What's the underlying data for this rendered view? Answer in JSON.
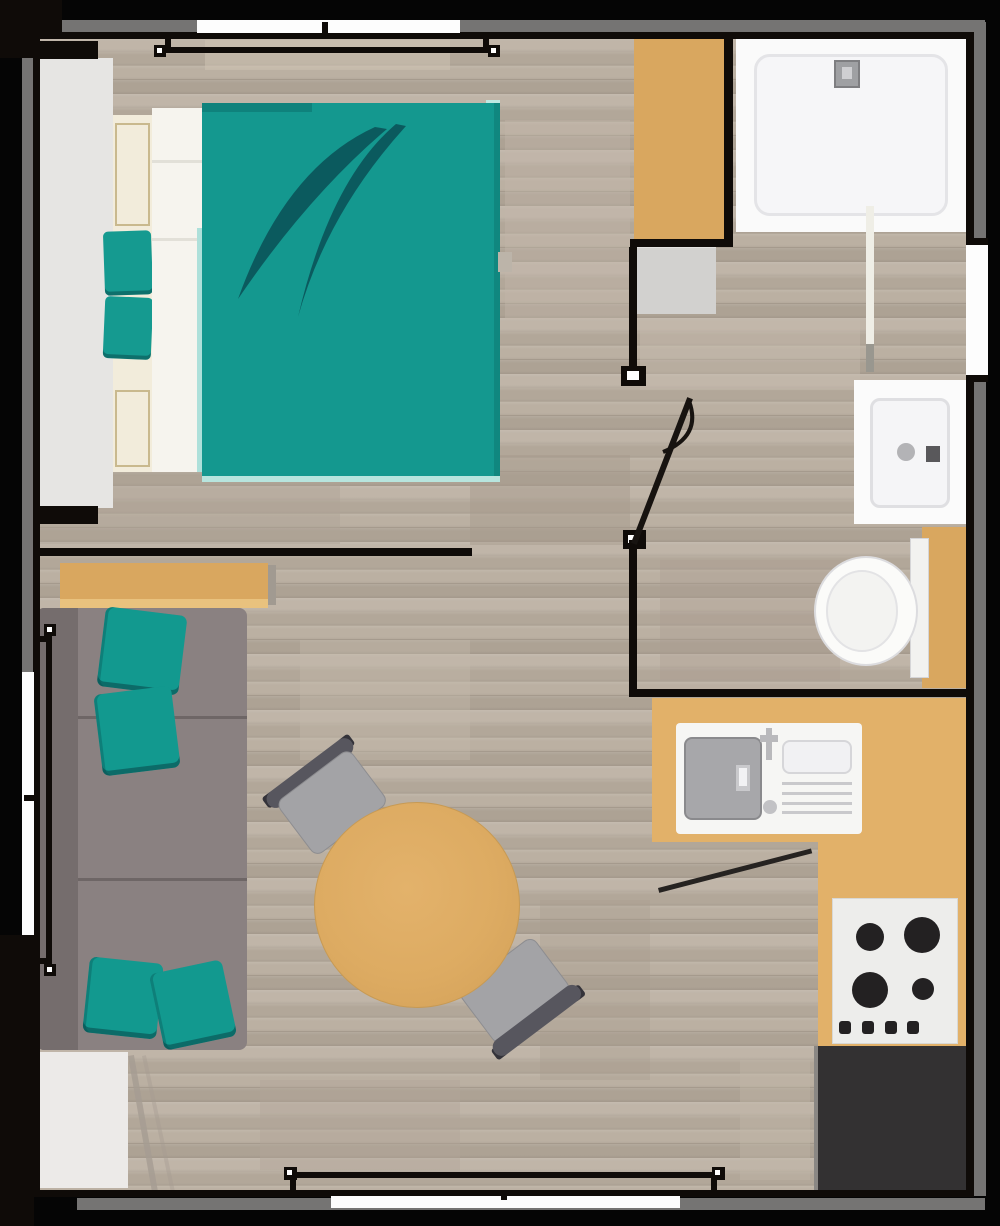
{
  "title": "Studio apartment floor plan (top-down render)",
  "palette": {
    "wall": "#0f0b08",
    "wall_band": "#757473",
    "floor_wood": "#b6ab9e",
    "accent_teal": "#14988f",
    "accent_teal_dark": "#0b5a5e",
    "furniture_tan": "#d9a75f",
    "counter_tan": "#e2b169",
    "sofa_gray": "#8a8181",
    "fixture_white": "#fafafa",
    "appliance_charcoal": "#333132"
  },
  "rooms": {
    "bedroom": {
      "label": "Bedroom",
      "items": [
        "double bed with teal duvet",
        "two teal pillows",
        "light-gray wardrobe",
        "tall tan cabinet",
        "gray dresser"
      ]
    },
    "bathroom": {
      "label": "Bathroom",
      "items": [
        "shower tray with drain",
        "glass screen",
        "washbasin",
        "toilet",
        "tan shelf"
      ]
    },
    "living": {
      "label": "Living area",
      "items": [
        "gray sofa",
        "four teal cushions",
        "tan console",
        "light rug"
      ]
    },
    "dining": {
      "label": "Dining area",
      "items": [
        "round tan table",
        "two gray chairs"
      ]
    },
    "kitchen": {
      "label": "Kitchen",
      "items": [
        "L-shaped tan counter",
        "inset sink with drainer",
        "four-burner cooktop",
        "charcoal appliance block"
      ]
    }
  },
  "openings": {
    "windows": [
      {
        "side": "top"
      },
      {
        "side": "left"
      },
      {
        "side": "right"
      },
      {
        "side": "bottom"
      }
    ],
    "doors": [
      {
        "room": "bathroom",
        "state": "open"
      }
    ]
  },
  "counts": {
    "windows": 4,
    "doors": 1,
    "burners": 4,
    "sofa_cushions": 4,
    "bed_pillows": 2,
    "chairs": 2
  }
}
